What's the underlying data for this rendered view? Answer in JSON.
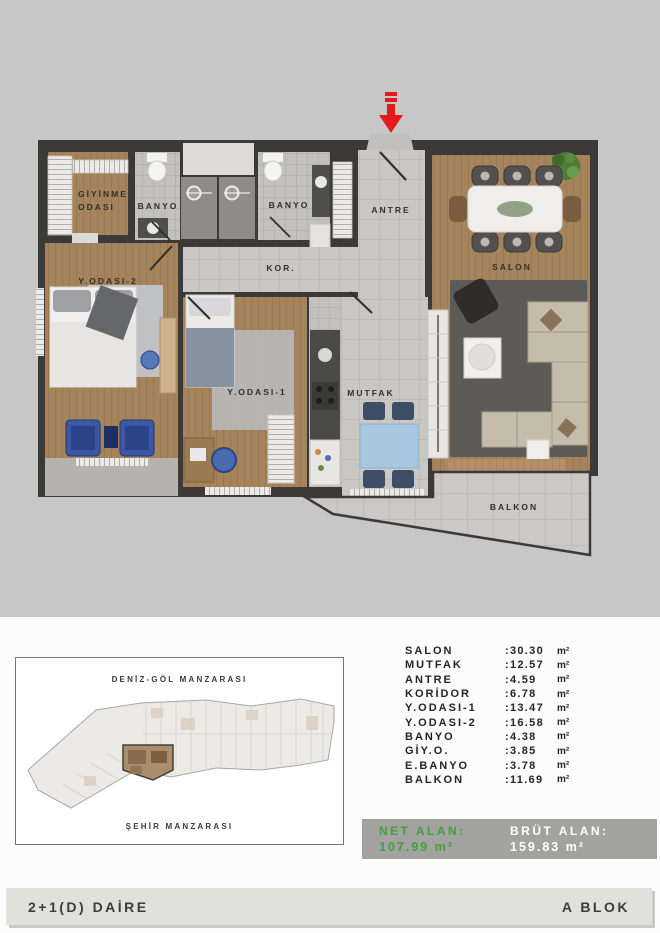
{
  "colors": {
    "page_bg": "#c7c7c7",
    "panel_bg": "#fcfcfc",
    "accent_green": "#3fa33c",
    "summary_bg": "#a2a2a0",
    "footer_bg": "#e1e1db",
    "arrow_red": "#e31b1b",
    "wall_dark": "#3b3a37",
    "wood_floor": "#a5845c"
  },
  "floor_plan": {
    "labels": {
      "giyinme_line1": "GİYİNME",
      "giyinme_line2": "ODASI",
      "banyo_left": "BANYO",
      "banyo_right": "BANYO",
      "antre": "ANTRE",
      "koridor": "KOR.",
      "y_odasi_2": "Y.ODASI-2",
      "y_odasi_1": "Y.ODASI-1",
      "mutfak": "MUTFAK",
      "salon": "SALON",
      "balkon": "BALKON"
    }
  },
  "site_plan": {
    "top_label": "DENİZ-GÖL MANZARASI",
    "bottom_label": "ŞEHİR MANZARASI"
  },
  "area_table": {
    "rows": [
      {
        "name": "SALON",
        "value": ":30.30",
        "unit": "m²"
      },
      {
        "name": "MUTFAK",
        "value": ":12.57",
        "unit": "m²"
      },
      {
        "name": "ANTRE",
        "value": ":4.59",
        "unit": "m²"
      },
      {
        "name": "KORİDOR",
        "value": ":6.78",
        "unit": "m²"
      },
      {
        "name": "Y.ODASI-1",
        "value": ":13.47",
        "unit": "m²"
      },
      {
        "name": "Y.ODASI-2",
        "value": ":16.58",
        "unit": "m²"
      },
      {
        "name": "BANYO",
        "value": ":4.38",
        "unit": "m²"
      },
      {
        "name": "GİY.O.",
        "value": ":3.85",
        "unit": "m²"
      },
      {
        "name": "E.BANYO",
        "value": ":3.78",
        "unit": "m²"
      },
      {
        "name": "BALKON",
        "value": ":11.69",
        "unit": "m²"
      }
    ]
  },
  "summary": {
    "net_label": "NET ALAN:",
    "net_value": "107.99 m²",
    "brut_label": "BRÜT ALAN:",
    "brut_value": "159.83 m²"
  },
  "footer": {
    "left": "2+1(D) DAİRE",
    "right": "A BLOK"
  }
}
